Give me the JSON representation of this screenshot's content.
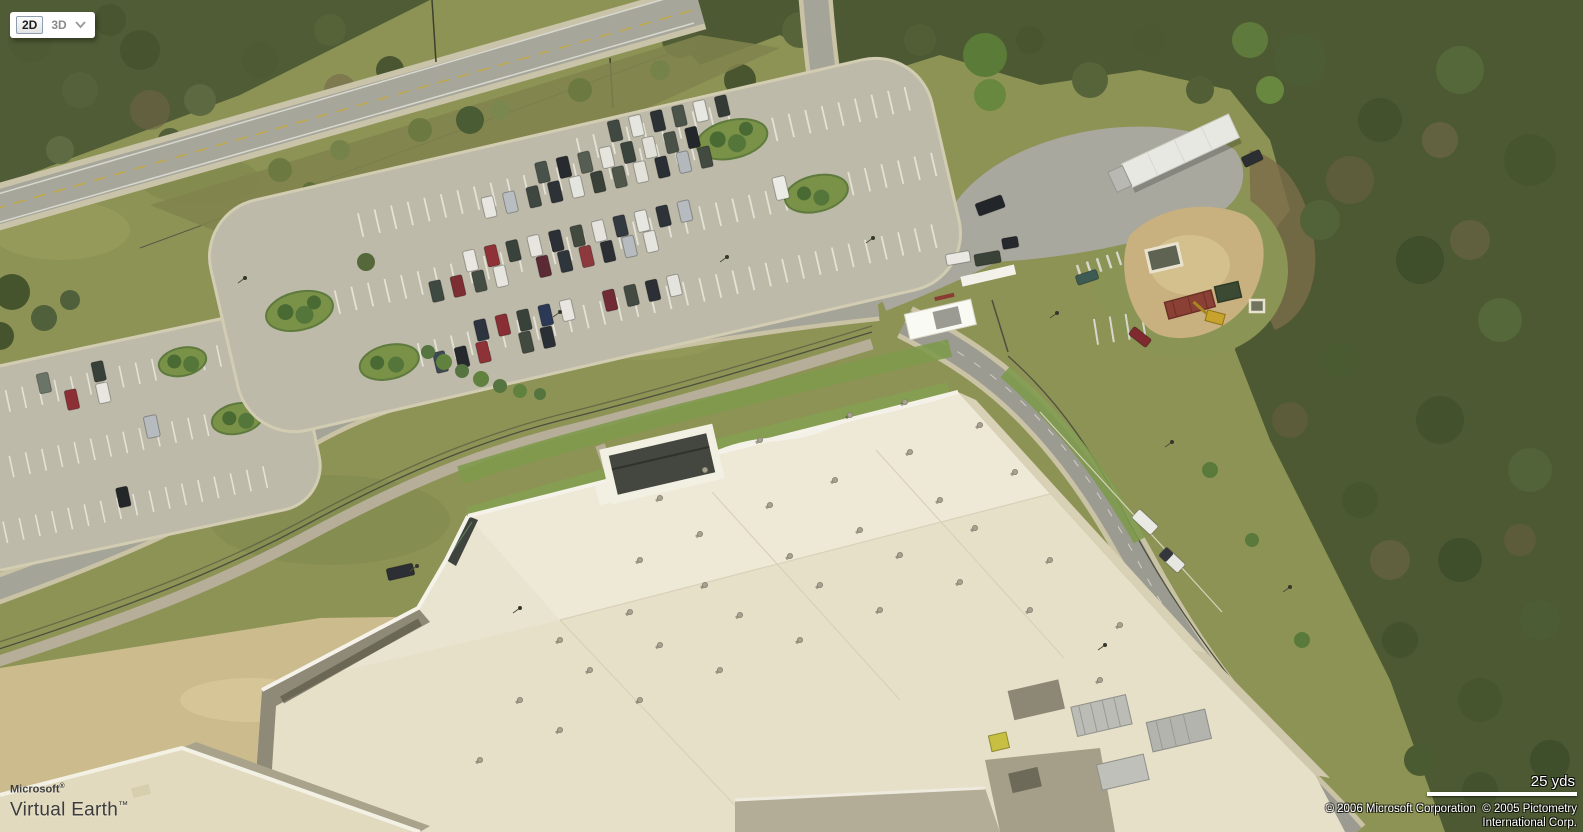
{
  "view_controls": {
    "label_2d": "2D",
    "label_3d": "3D",
    "selected_mode": "2D",
    "dropdown_icon": "chevron-down"
  },
  "branding": {
    "company": "Microsoft",
    "registered_symbol": "®",
    "product": "Virtual Earth",
    "trademark_symbol": "™"
  },
  "scale": {
    "label": "25 yds"
  },
  "attribution": {
    "line1": "© 2006 Microsoft Corporation  © 2005 Pictometry",
    "line2": "International Corp."
  },
  "colors": {
    "attribution_text": "#ffffff",
    "logo_text": "#3c3c3c",
    "scale_bar": "#ffffff",
    "selected_button_border": "#8e9db0"
  }
}
